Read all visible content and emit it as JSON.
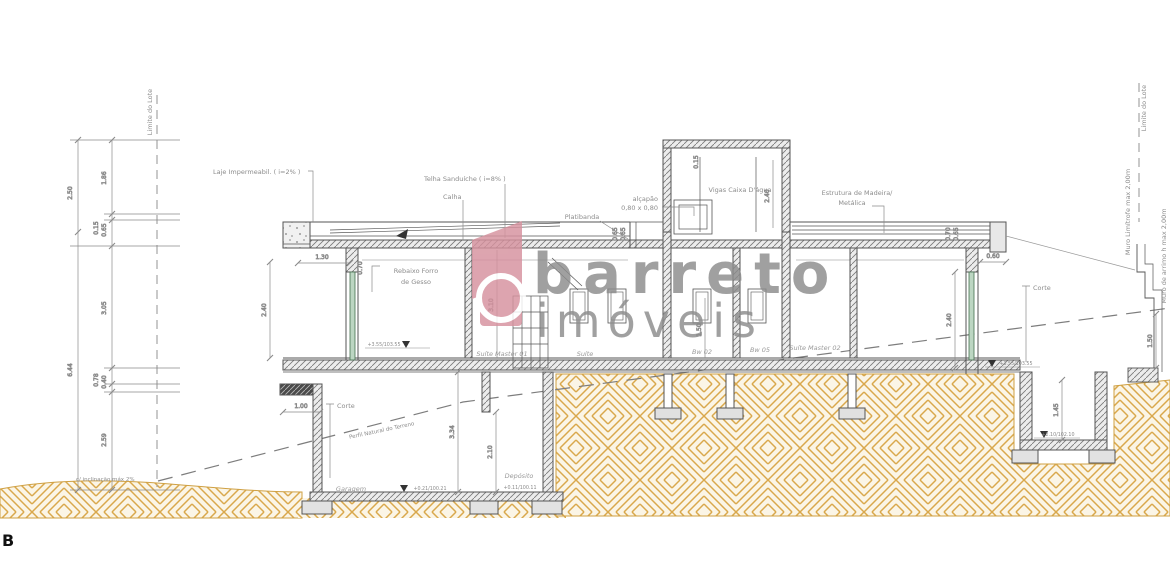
{
  "page": {
    "corner": "B"
  },
  "watermark": {
    "brand": "barreto",
    "sub": "imóveis",
    "pink": "#d6919e",
    "grey": "#9b9b9b"
  },
  "colors": {
    "hatch_tan": "#d9a84c",
    "ground_fill": "#fbf5e6",
    "line_grey": "#555555",
    "label_grey": "#8c8c8c",
    "green_stroke": "#45704f",
    "green_fill": "#bcd6c2"
  },
  "labels": {
    "limite_lote_left": "Limite do Lote",
    "limite_lote_right": "Limite do Lote",
    "laje": "Laje Impermeabil. ( i=2% )",
    "telha": "Telha Sanduíche ( i=8% )",
    "calha": "Calha",
    "platibanda": "Platibanda",
    "alcapao_1": "alçapão",
    "alcapao_2": "0,80 x 0,80",
    "vigas": "Vigas Caixa D'água",
    "estrutura_1": "Estrutura de Madeira/",
    "estrutura_2": "Metálica",
    "rebaixo_1": "Rebaixo Forro",
    "rebaixo_2": "de Gesso",
    "muro_limitrofe": "Muro Limítrofe max 2,00m",
    "muro_arrimo": "Muro de arrimo h max 2,00m",
    "perfil": "Perfil Natural do Terreno",
    "corte_left": "Corte",
    "corte_right": "Corte",
    "inclinacao": "c/ inclinação máx 2%"
  },
  "rooms": {
    "suite_master_01": "Suíte Master 01",
    "suite": "Suíte",
    "bw02": "Bw 02",
    "bw05": "Bw 05",
    "suite_master_02": "Suíte Master 02",
    "garagem": "Garagem",
    "deposito": "Depósito"
  },
  "dims": {
    "d250": "2.50",
    "d186": "1.86",
    "d015": "0.15",
    "d065": "0.65",
    "d305": "3.05",
    "d078": "0.78",
    "d040": "0.40",
    "d644": "6.44",
    "d259": "2.59",
    "d130": "1.30",
    "d240l": "2.40",
    "d310": "3.10",
    "d150bw": "1.50",
    "d100": "1.00",
    "d334": "3.34",
    "d210": "2.10",
    "d060": "0.60",
    "d240r": "2.40",
    "d145": "1.45",
    "d150": "1.50",
    "d065a": "0.65",
    "d065b": "0.65",
    "d070a": "0.70",
    "d065c": "0.65",
    "d070b": "0.70",
    "d240t": "2.40",
    "d015t": "0.15"
  },
  "levels": {
    "suites_l": "+3.55/103.55",
    "suites_r": "+3.55/103.55",
    "garage": "+0.21/100.21",
    "deposito": "+0.11/100.11",
    "pit": "+2.10/102.10"
  }
}
